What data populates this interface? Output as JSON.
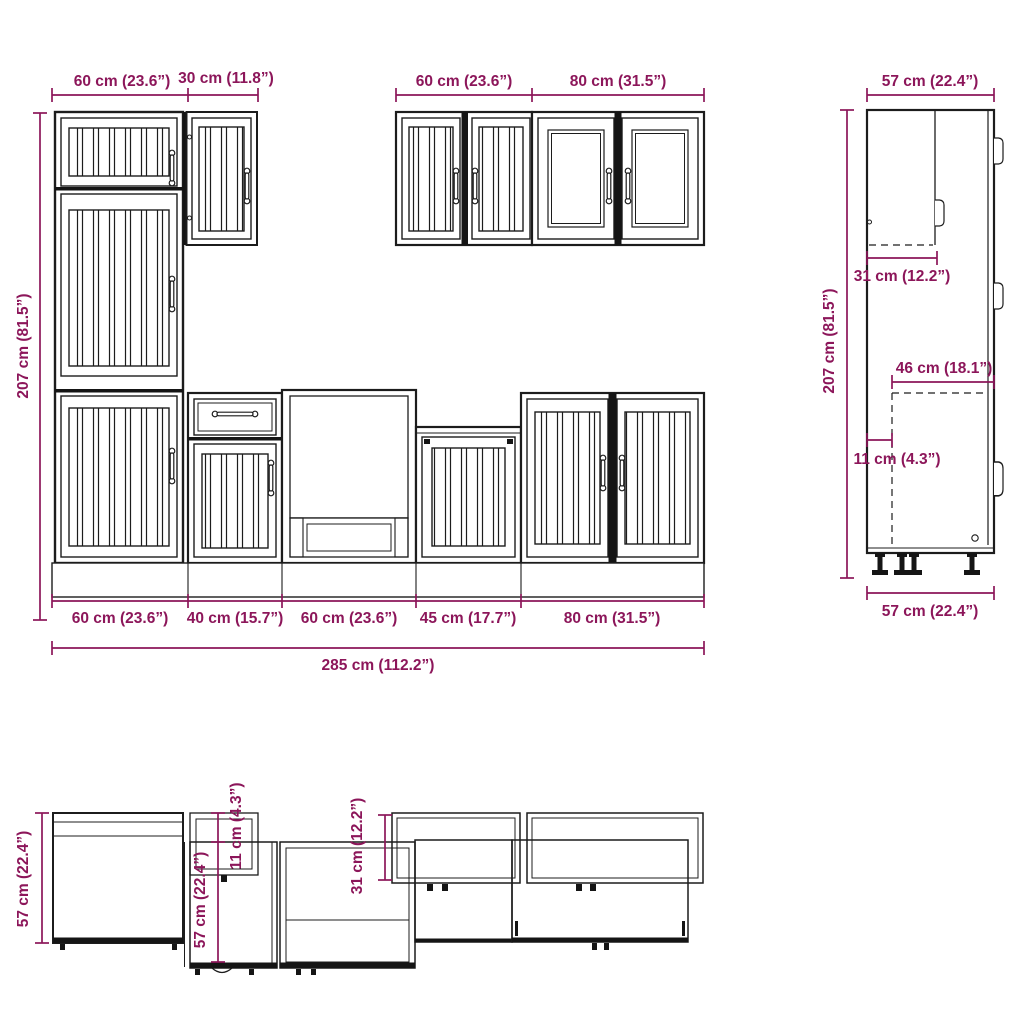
{
  "palette": {
    "dimension_color": "#8C165A",
    "drawing_line_color": "#1C1C1C",
    "background": "#FFFFFF"
  },
  "front_view": {
    "top_widths": {
      "tall_cabinet": "60 cm (23.6”)",
      "upper_cabinet_30": "30 cm (11.8”)",
      "upper_cabinet_60": "60 cm (23.6”)",
      "upper_cabinet_80": "80 cm (31.5”)"
    },
    "height": "207 cm (81.5”)",
    "base_widths": {
      "segment_60_left": "60 cm (23.6”)",
      "segment_40": "40 cm (15.7”)",
      "segment_60_mid": "60 cm (23.6”)",
      "segment_45": "45 cm (17.7”)",
      "segment_80": "80 cm (31.5”)"
    },
    "total_width": "285 cm (112.2”)"
  },
  "side_view": {
    "top_depth": "57 cm (22.4”)",
    "height": "207 cm (81.5”)",
    "upper_cabinet_depth": "31 cm (12.2”)",
    "interior_depth": "46 cm (18.1”)",
    "plinth_recess": "11 cm (4.3”)",
    "bottom_depth": "57 cm (22.4”)"
  },
  "top_view": {
    "depth": "57 cm (22.4”)",
    "base_cabinet_depth": "57 cm (22.4”)",
    "drawer_extension": "11 cm (4.3”)",
    "upper_cabinet_depth": "31 cm (12.2”)"
  }
}
